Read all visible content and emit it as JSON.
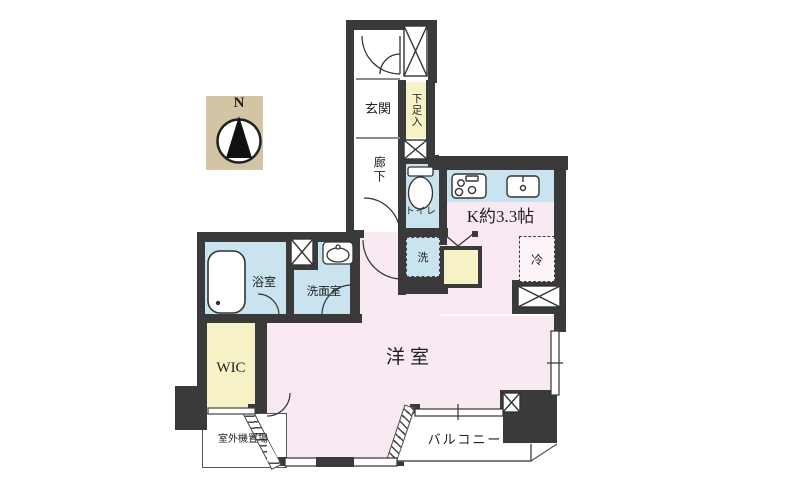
{
  "compass": {
    "label": "N"
  },
  "rooms": {
    "genkan": "玄関",
    "shoe_cabinet": "下足入",
    "corridor": "廊下",
    "toilet": "トイレ",
    "kitchen": "K約3.3帖",
    "washer": "洗",
    "fridge": "冷",
    "bathroom": "浴室",
    "washroom": "洗面室",
    "wic": "WIC",
    "main_room": "洋室",
    "balcony": "バルコニー",
    "outdoor_unit": "室外機置場"
  },
  "colors": {
    "wall": "#3a3a3a",
    "room_pink": "#f8e9f3",
    "water_blue": "#c9e4ef",
    "closet_cream": "#f6f2c6",
    "porch_beige": "#d3c4a4",
    "line": "#444444"
  }
}
